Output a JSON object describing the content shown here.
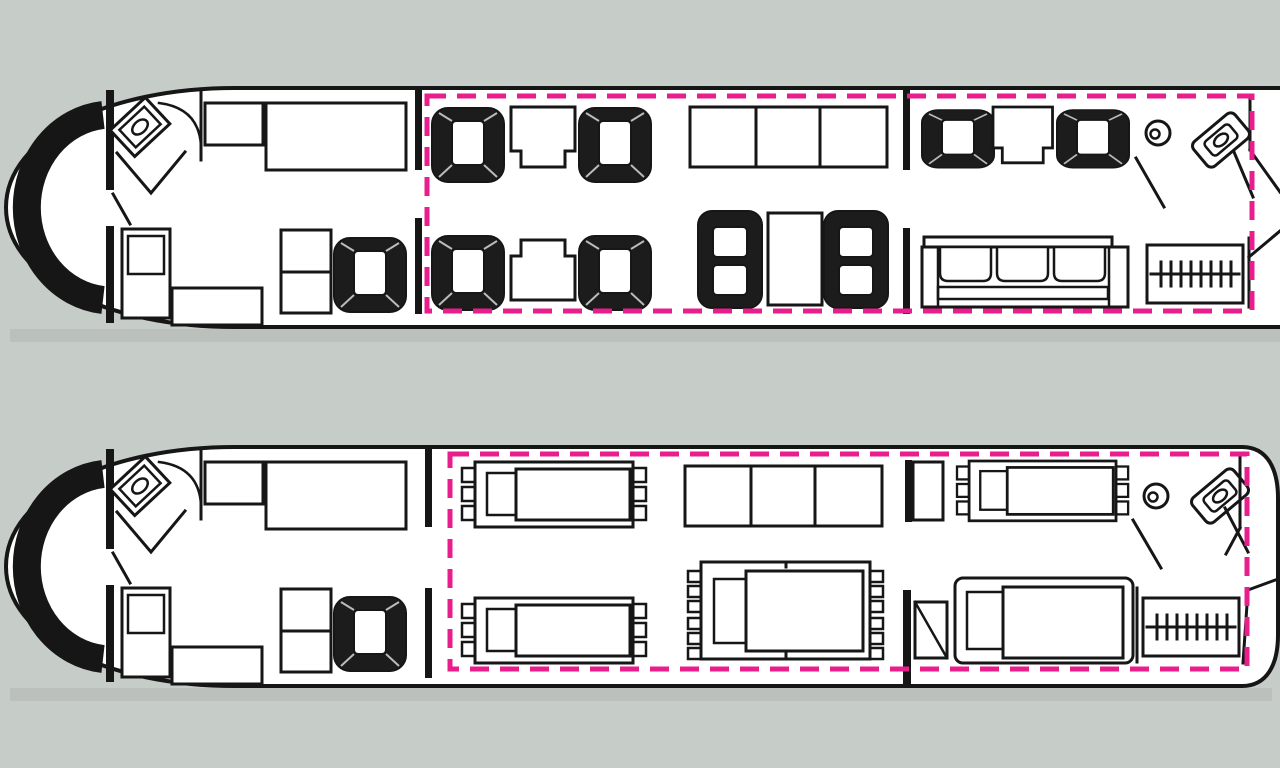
{
  "title": "Business jet cabin floor plans: day seating configuration and night berthing configuration, mid/aft cabin zone highlighted with dashed outline",
  "canvas": {
    "width": 1280,
    "height": 768
  },
  "colors": {
    "background": "#c6ccc7",
    "outline": "#161616",
    "interior": "#ffffff",
    "seat_fill": "#1c1c1c",
    "highlight": "#e81e8c"
  },
  "configurations": [
    {
      "id": "day",
      "position": "top",
      "highlight_zone": "mid-and-aft-cabin",
      "cockpit": [
        "radome-crescent",
        "cockpit"
      ],
      "forward_section": [
        "galley-sink",
        "galley-door",
        "galley-counter-small",
        "galley-counter-large",
        "crew-seat",
        "low-sideboard",
        "two-bay-cabinet",
        "club-seat"
      ],
      "mid_section": [
        "club-seat",
        "side-table",
        "club-seat",
        "three-bay-credenza",
        "club-seat",
        "side-table",
        "club-seat",
        "four-place-conference-group-with-table"
      ],
      "aft_section": [
        "club-seat",
        "side-table",
        "club-seat",
        "three-seat-divan",
        "lavatory-sink",
        "lavatory-toilet",
        "wardrobe-closet"
      ]
    },
    {
      "id": "night",
      "position": "bottom",
      "highlight_zone": "mid-and-aft-cabin",
      "cockpit": [
        "radome-crescent",
        "cockpit"
      ],
      "forward_section": [
        "galley-sink",
        "galley-door",
        "galley-counter-small",
        "galley-counter-large",
        "crew-seat",
        "low-sideboard",
        "two-bay-cabinet",
        "club-seat"
      ],
      "mid_section": [
        "single-berth",
        "three-bay-credenza",
        "single-berth",
        "double-berth"
      ],
      "aft_section": [
        "small-cabinet",
        "single-berth",
        "door-panel",
        "single-berth",
        "wardrobe-closet",
        "lavatory-sink",
        "lavatory-toilet"
      ]
    }
  ]
}
